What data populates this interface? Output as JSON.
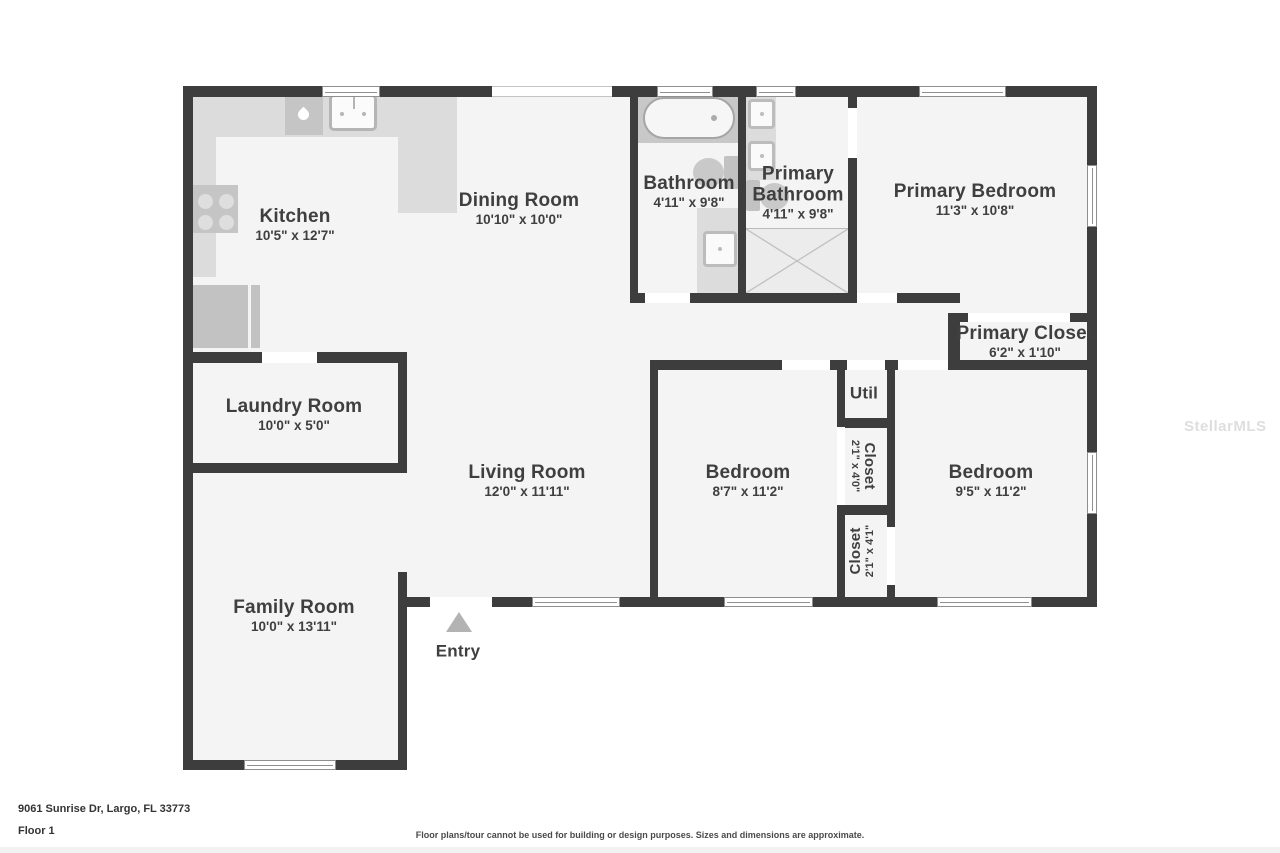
{
  "title": "Floor plan",
  "rooms": {
    "kitchen": {
      "name": "Kitchen",
      "dims": "10'5\" x 12'7\""
    },
    "dining": {
      "name": "Dining Room",
      "dims": "10'10\" x 10'0\""
    },
    "bathroom": {
      "name": "Bathroom",
      "dims": "4'11\" x 9'8\""
    },
    "primary_bathroom": {
      "name": "Primary Bathroom",
      "dims": "4'11\" x 9'8\""
    },
    "primary_bedroom": {
      "name": "Primary Bedroom",
      "dims": "11'3\" x 10'8\""
    },
    "primary_closet": {
      "name": "Primary Closet",
      "dims": "6'2\" x 1'10\""
    },
    "laundry": {
      "name": "Laundry Room",
      "dims": "10'0\" x 5'0\""
    },
    "living": {
      "name": "Living Room",
      "dims": "12'0\" x 11'11\""
    },
    "bedroom_left": {
      "name": "Bedroom",
      "dims": "8'7\" x 11'2\""
    },
    "bedroom_right": {
      "name": "Bedroom",
      "dims": "9'5\" x 11'2\""
    },
    "util": {
      "name": "Util"
    },
    "closet_upper": {
      "name": "Closet",
      "dims": "2'1\" x 4'0\""
    },
    "closet_lower": {
      "name": "Closet",
      "dims": "2'1\" x 4'1\""
    },
    "family": {
      "name": "Family Room",
      "dims": "10'0\" x 13'11\""
    },
    "entry": {
      "name": "Entry"
    }
  },
  "footer": {
    "address": "9061 Sunrise Dr, Largo, FL 33773",
    "floor": "Floor 1",
    "disclaimer": "Floor plans/tour cannot be used for building or design purposes. Sizes and dimensions are approximate."
  },
  "watermark": "StellarMLS",
  "colors": {
    "wall": "#3d3d3d",
    "floor": "#f4f4f4",
    "counter": "#dcdcdc",
    "appliance": "#c5c5c5",
    "label": "#3f3f3f"
  }
}
